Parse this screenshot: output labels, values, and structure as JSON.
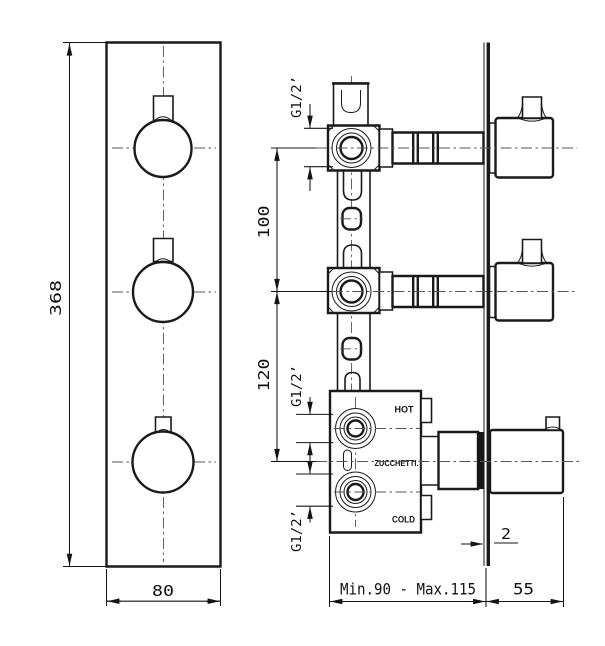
{
  "drawing": {
    "front_view": {
      "height_dim": "368",
      "width_dim": "80"
    },
    "side_view": {
      "thread_label_top": "G1/2’",
      "thread_label_hot": "G1/2’",
      "thread_label_cold": "G1/2’",
      "spacing_top_dim": "100",
      "spacing_bottom_dim": "120",
      "hot_label": "HOT",
      "cold_label": "COLD",
      "brand_label": "ZUCCHETTI.",
      "wall_thickness_dim": "2",
      "depth_range_dim": "Min.90 - Max.115",
      "protrusion_dim": "55"
    },
    "colors": {
      "line": "#1a1a1a",
      "centerline": "#555555",
      "background": "#ffffff"
    }
  }
}
